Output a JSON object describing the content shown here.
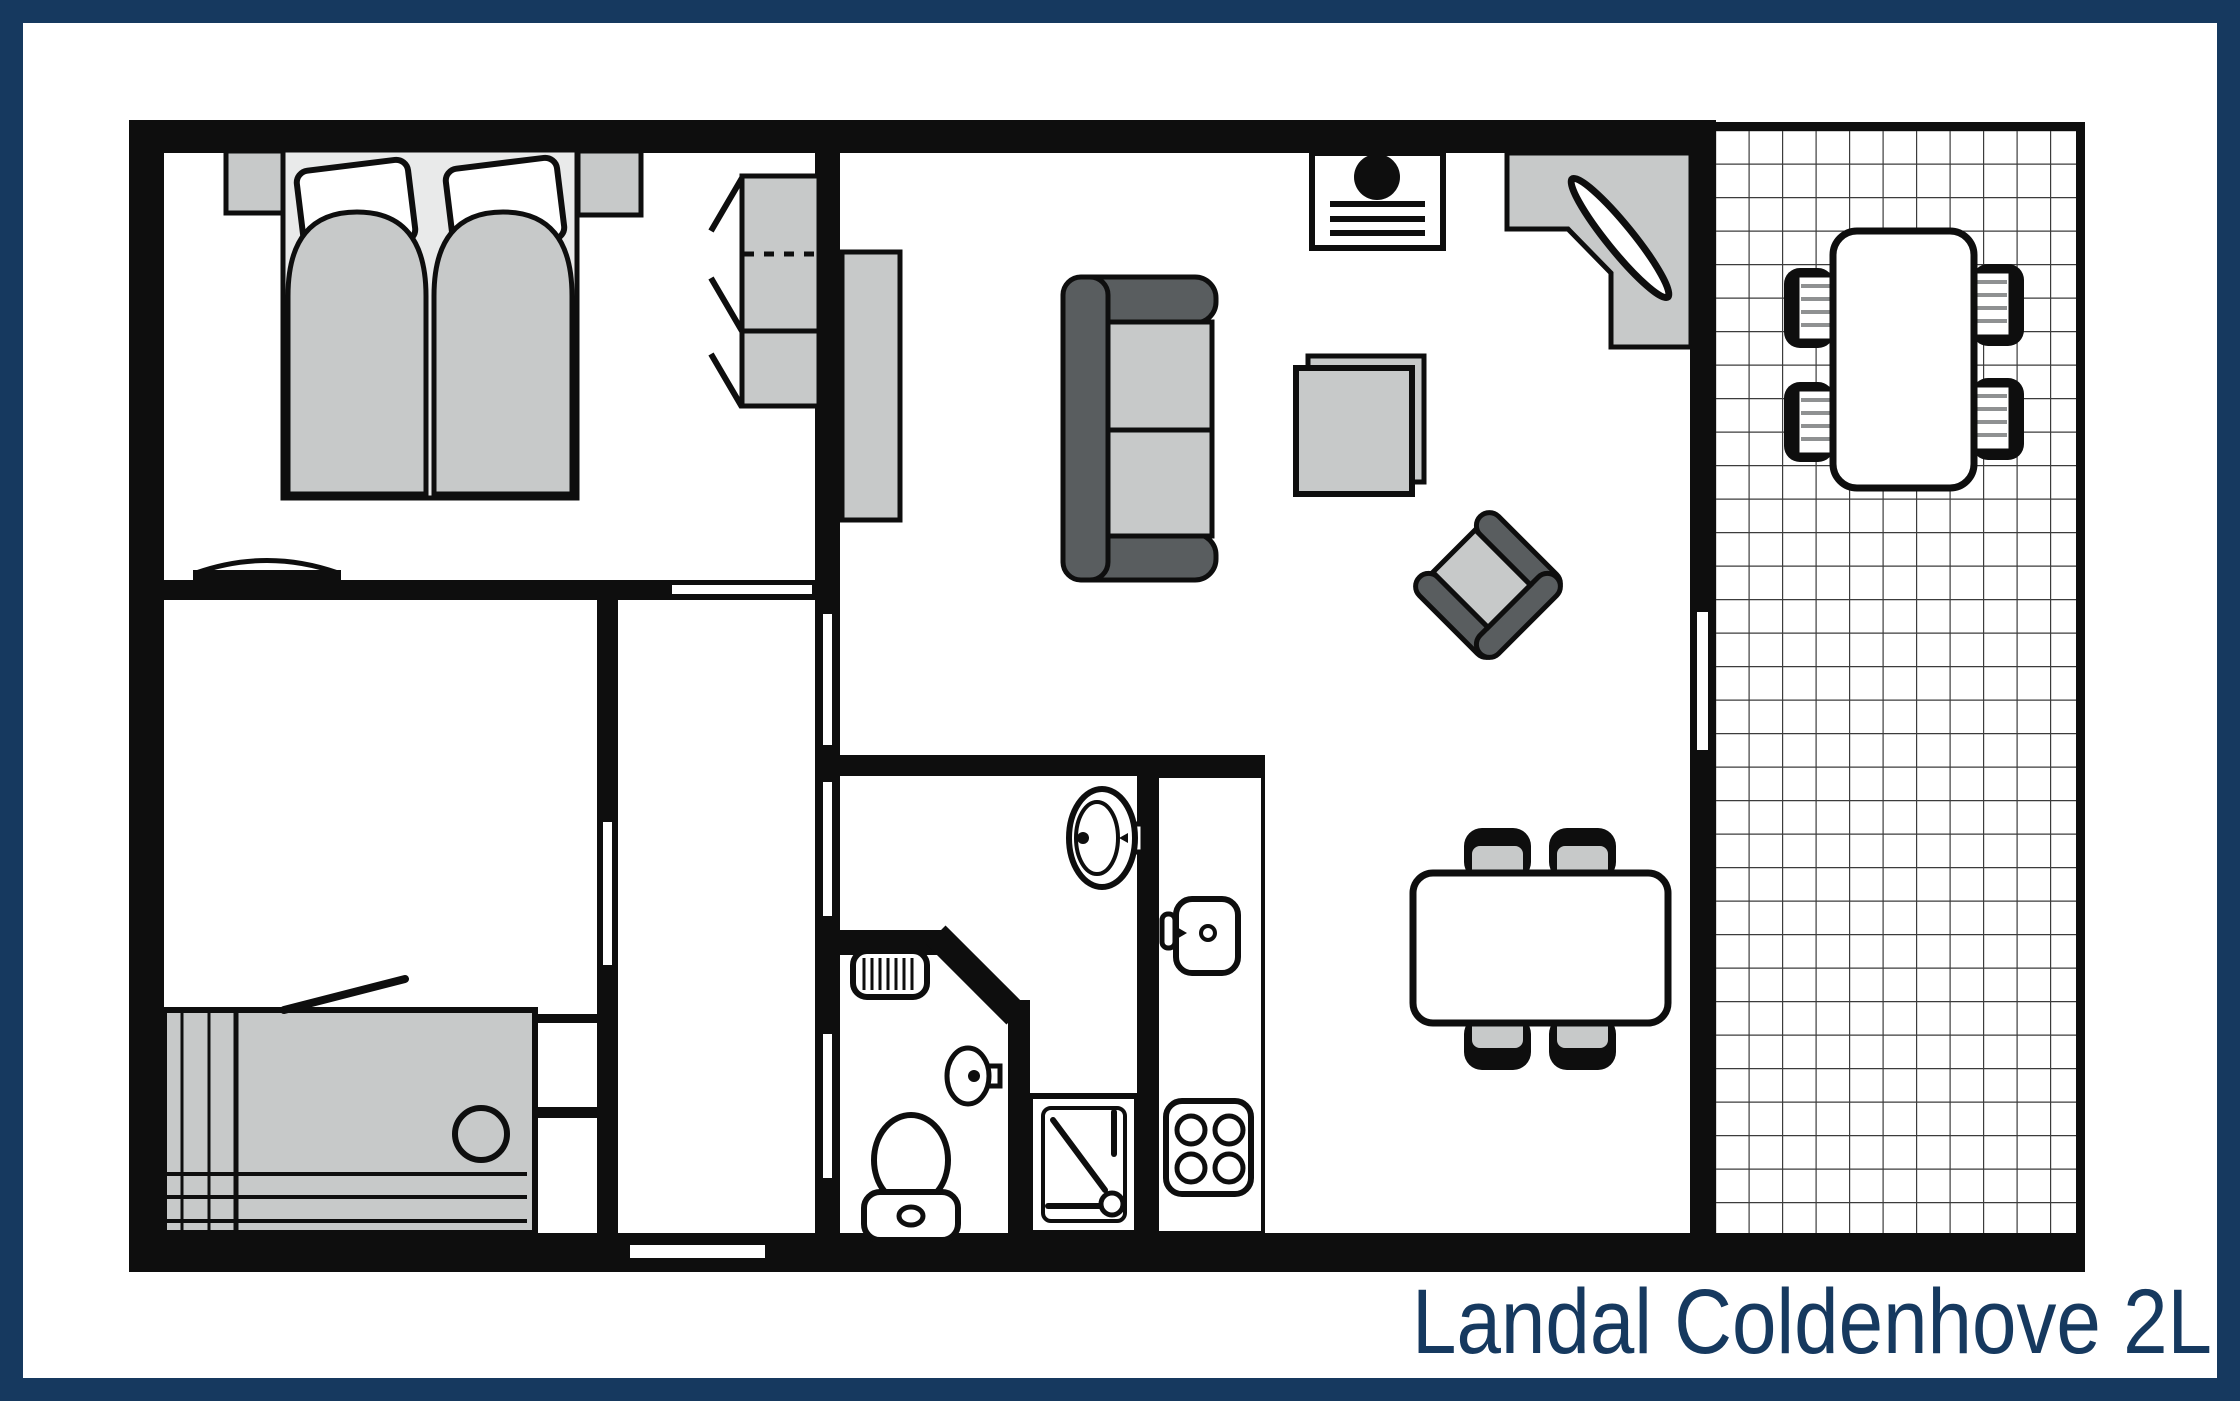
{
  "title": "Landal Coldenhove 2L",
  "colors": {
    "frame_navy": "#16395f",
    "wall_black": "#0e0e0e",
    "furniture_gray": "#c7c9c9",
    "furniture_light_gray": "#e9eaea",
    "sofa_dark_gray": "#595d5f",
    "chair_slat_gray": "#8f9192",
    "grid_line_gray": "#3c3c3c",
    "floor_white": "#ffffff"
  },
  "floor_plan": {
    "rooms": [
      "bedroom-1",
      "bedroom-2",
      "hall",
      "bathroom",
      "toilet",
      "kitchen",
      "living-dining-room",
      "terrace"
    ],
    "furniture_icons": [
      "double-bed",
      "pillow",
      "nightstand",
      "wardrobe",
      "wall-shelf",
      "bed",
      "sideboard",
      "sofa",
      "tv",
      "corner-desk",
      "desk-chair",
      "side-table",
      "armchair",
      "dining-table",
      "dining-chair",
      "kitchen-counter",
      "kitchen-sink",
      "stove",
      "washbasin",
      "hand-basin",
      "toilet-bowl",
      "radiator",
      "shower",
      "terrace-table",
      "terrace-chair",
      "tile-grid"
    ]
  }
}
